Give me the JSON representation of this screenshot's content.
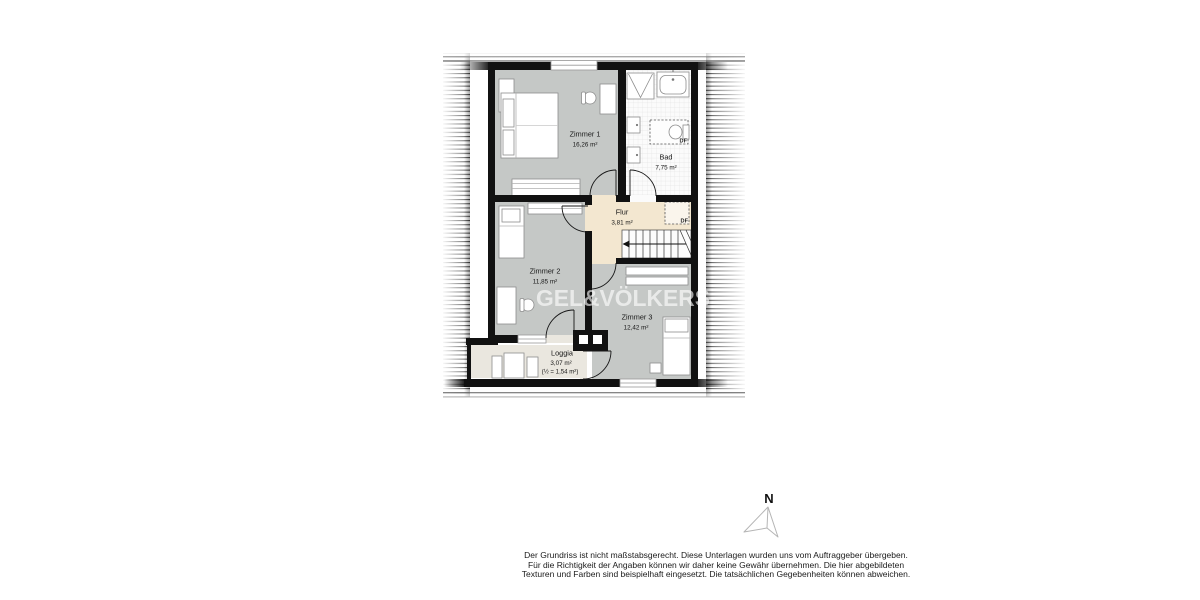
{
  "floor_plan": {
    "watermark": "GEL&VÖLKERS",
    "roof_window_label": "DF",
    "rooms": {
      "zimmer1": {
        "name": "Zimmer 1",
        "area": "16,26 m²"
      },
      "zimmer2": {
        "name": "Zimmer 2",
        "area": "11,85 m²"
      },
      "zimmer3": {
        "name": "Zimmer 3",
        "area": "12,42 m²"
      },
      "bad": {
        "name": "Bad",
        "area": "7,75 m²"
      },
      "flur": {
        "name": "Flur",
        "area": "3,81 m²"
      },
      "loggia": {
        "name": "Loggia",
        "area": "3,07 m²",
        "area_note": "(½ = 1,54 m²)"
      }
    },
    "colors": {
      "wall": "#111111",
      "room_floor": "#c5c8c6",
      "hall_floor": "#f3e7d0",
      "loggia_floor": "#eae7df",
      "bath_floor": "#fbfbfb"
    }
  },
  "compass": {
    "north_label": "N"
  },
  "disclaimer": {
    "line1": "Der Grundriss ist nicht maßstabsgerecht. Diese Unterlagen wurden uns vom Auftraggeber übergeben.",
    "line2": "Für die Richtigkeit der Angaben können wir daher keine Gewähr übernehmen. Die hier abgebildeten",
    "line3": "Texturen und Farben sind beispielhaft eingesetzt. Die tatsächlichen Gegebenheiten können abweichen."
  }
}
